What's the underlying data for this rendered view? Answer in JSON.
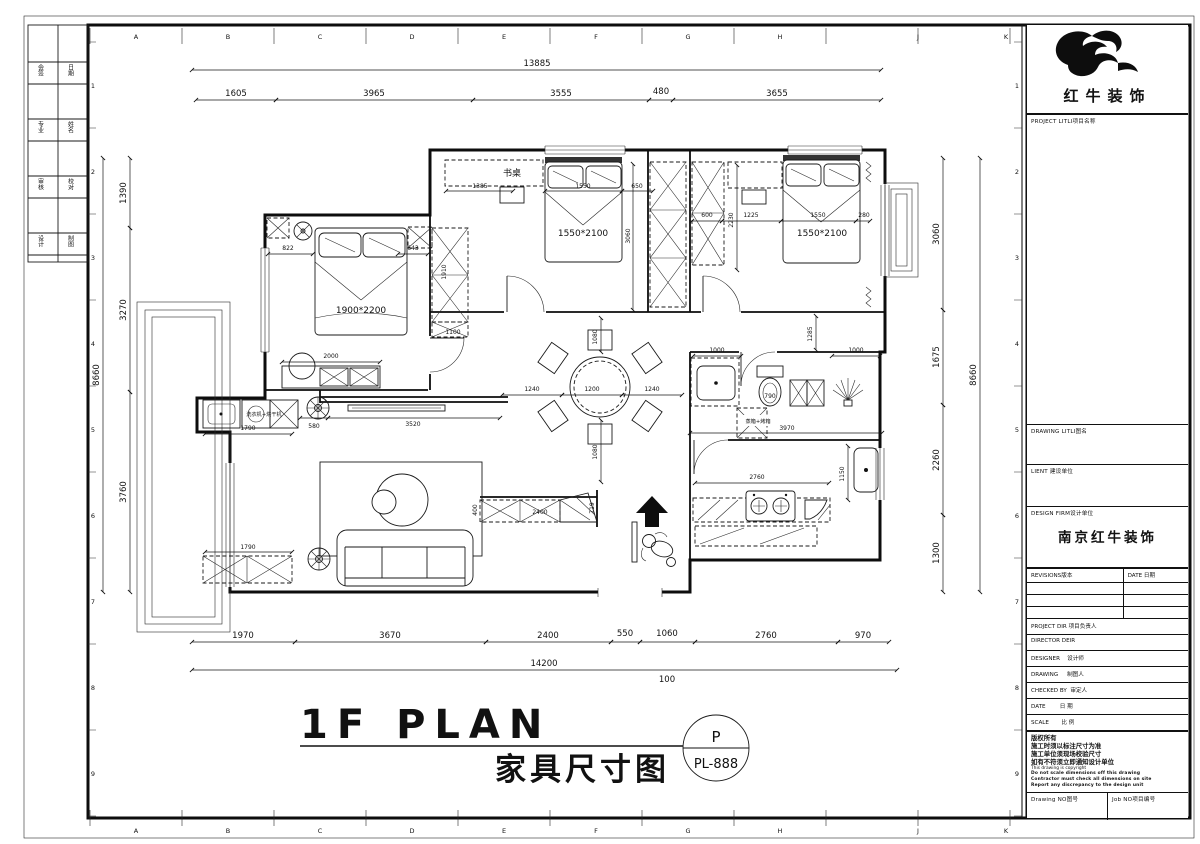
{
  "sheet": {
    "letters": [
      "A",
      "B",
      "C",
      "D",
      "E",
      "F",
      "G",
      "H",
      "J",
      "K"
    ],
    "numbers": [
      "1",
      "2",
      "3",
      "4",
      "5",
      "6",
      "7",
      "8",
      "9"
    ],
    "stamp": [
      "会签",
      "日期",
      "专业",
      "姓名",
      "审核",
      "校对",
      "设计",
      "制图"
    ]
  },
  "titleblock": {
    "brand": "红牛装饰",
    "project_label": "PROJECT LITLI项目名称",
    "drawing_label": "DRAWING LITLI图名",
    "client_label": "LIENT 建设单位",
    "firm_label": "DESIGN FIRM设计单位",
    "firm_name": "南京红牛装饰",
    "revisions_label": "REVISIONS版本",
    "revision_date_label": "DATE 日期",
    "rows": [
      "PROJECT DIR 项目负责人",
      "DIRECTOR DEIR",
      "DESIGNER    设计师",
      "DRAWING     制图人",
      "CHECKED BY  审定人",
      "DATE        日 期",
      "SCALE       比 例"
    ],
    "copyright_cn": [
      "版权所有",
      "施工时须以标注尺寸为准",
      "施工单位须现场校验尺寸",
      "如有不符须立即通知设计单位"
    ],
    "copyright_en": "This drawing is copyright",
    "copyright_bold": [
      "Do not scale dimensions off this drawing",
      "Contractor must check all dimensions on site",
      "Report any discrepancy to the design unit"
    ],
    "drawing_no_label": "Drawing NO图号",
    "job_no_label": "Job NO项目编号"
  },
  "plan": {
    "title_en": "1F PLAN",
    "title_cn": "家具尺寸图",
    "sheet_letter": "P",
    "sheet_no": "PL-888",
    "rooms": {
      "bed_master": "1900*2200",
      "bed_mid": "1550*2100",
      "bed_right": "1550*2100",
      "desk": "书桌",
      "washer": "洗衣机+烘干机",
      "oven": "蒸箱+烤箱"
    },
    "dims": {
      "top_total": "13885",
      "top": [
        "1605",
        "3965",
        "3555",
        "480",
        "3655"
      ],
      "bottom": [
        "1970",
        "3670",
        "2400",
        "550",
        "1060",
        "2760",
        "970"
      ],
      "bottom_total": "14200",
      "bottom_offset": "100",
      "left_total": "8660",
      "left": [
        "1390",
        "3270",
        "3760"
      ],
      "right": [
        "3060",
        "1675",
        "2260",
        "1300"
      ],
      "right_total": "8660",
      "inner": {
        "m822": "822",
        "m643": "643",
        "m2000": "2000",
        "m1100": "1100",
        "w1910": "1910",
        "u1790": "1790",
        "u580": "580",
        "u3520": "3520",
        "c1790": "1790",
        "d1385": "1385",
        "d1550": "1550",
        "d650": "650",
        "d3060": "3060",
        "r600": "600",
        "r2230": "2230",
        "r1225": "1225",
        "r1550": "1550",
        "r280": "280",
        "t1240a": "1240",
        "t1200": "1200",
        "t1240b": "1240",
        "t1080a": "1080",
        "t1080b": "1080",
        "b1000a": "1000",
        "b790": "790",
        "b1000b": "1000",
        "b1285": "1285",
        "b3970": "3970",
        "k2760": "2760",
        "k1150": "1150",
        "s2400": "2400",
        "s719": "719",
        "s400": "400"
      }
    }
  }
}
